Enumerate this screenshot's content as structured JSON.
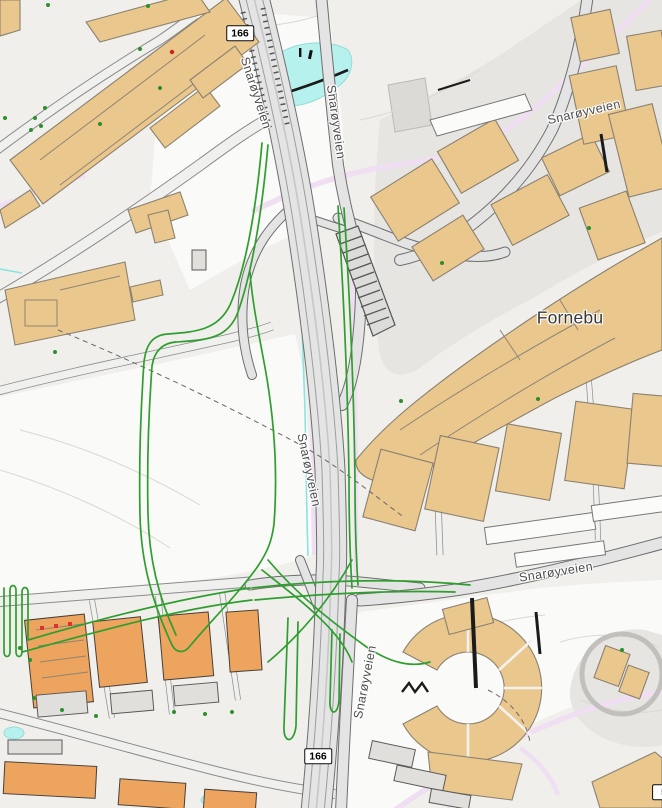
{
  "map": {
    "place": {
      "label": "Fornebu"
    },
    "road_labels": [
      {
        "id": "top-left",
        "label": "Snarøyveien"
      },
      {
        "id": "top-center",
        "label": "Snarøyveien"
      },
      {
        "id": "middle",
        "label": "Snarøyveien"
      },
      {
        "id": "top-right",
        "label": "Snarøyveien"
      },
      {
        "id": "mid-right",
        "label": "Snarøyveien"
      },
      {
        "id": "bottom",
        "label": "Snarøyveien"
      }
    ],
    "route_badges": [
      {
        "id": "top",
        "ref": "166"
      },
      {
        "id": "bottom",
        "ref": "166"
      },
      {
        "id": "corner-partial",
        "ref": "5"
      }
    ],
    "colors": {
      "background": "#f0efec",
      "building_tan": "#eac78c",
      "building_orange": "#eda45e",
      "route_overlay_green": "#2f9e2f",
      "water_cyan": "#b7f1ed",
      "footpath_pink": "#f0dff2",
      "road_fill": "#e4e4e4",
      "road_casing": "#6e6e6e",
      "poi_red": "#cc2222"
    }
  }
}
